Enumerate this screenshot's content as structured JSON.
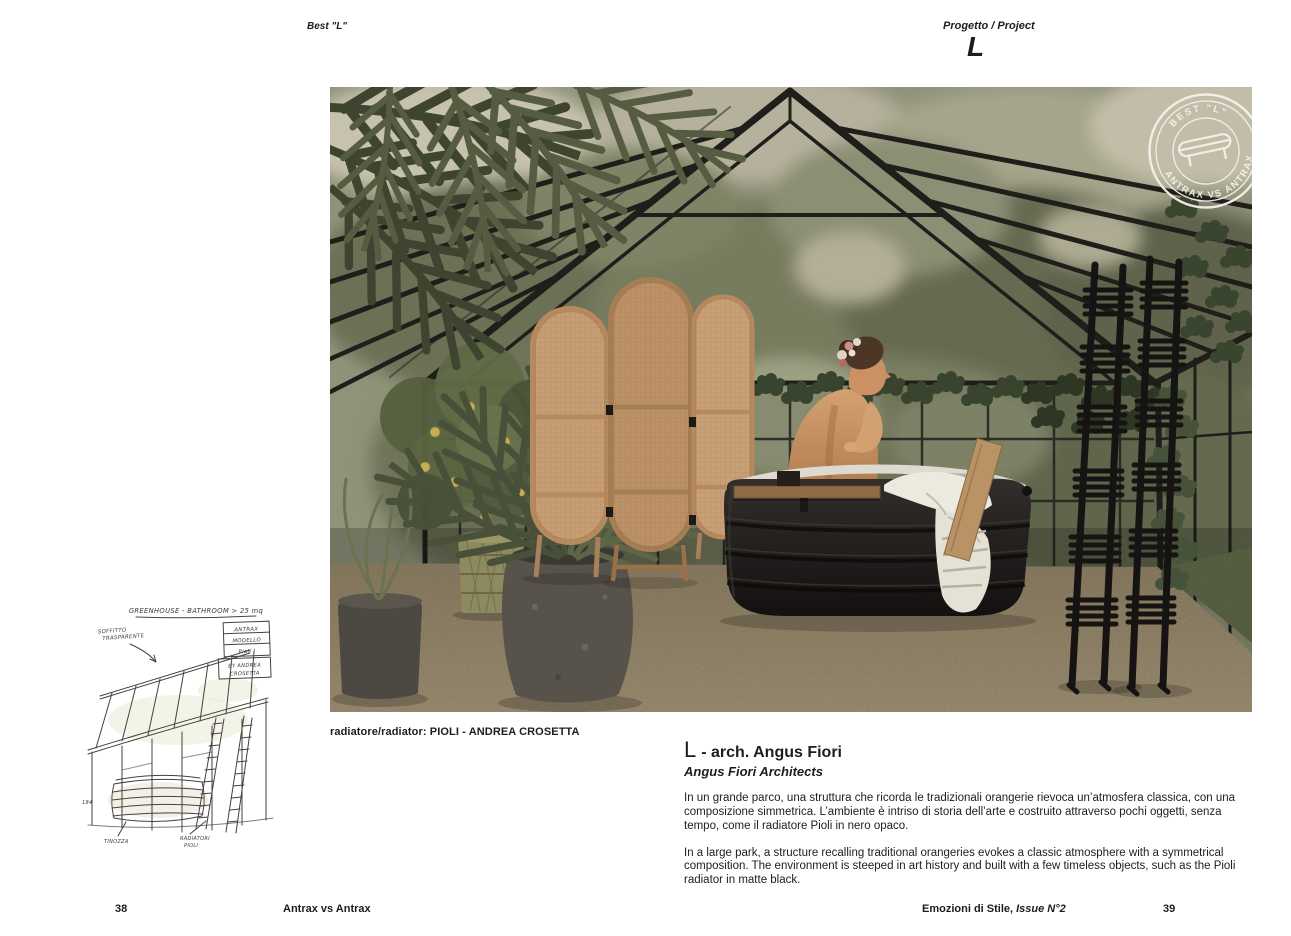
{
  "header": {
    "left_label": "Best \"L\"",
    "right_label": "Progetto / Project",
    "project_letter": "L"
  },
  "photo": {
    "caption": "radiatore/radiator: PIOLI - ANDREA CROSETTA",
    "stamp": {
      "top_text": "BEST \"L\"",
      "bottom_text": "ANTRAX VS ANTRAX"
    }
  },
  "sketch": {
    "title": "GREENHOUSE - BATHROOM > 25 mq",
    "ceiling_1": "SOFFITTO",
    "ceiling_2": "TRASPARENTE",
    "box_1": "ANTRAX",
    "box_2": "MODELLO",
    "box_3": "Pioli !",
    "box_4": "BY ANDREA",
    "box_5": "CROSETTA",
    "tub_label": "TINOZZA",
    "rad_label_1": "RADIATORI",
    "rad_label_2": "PIOLI",
    "number": "184"
  },
  "article": {
    "title_letter": "L",
    "title_rest": "- arch. Angus Fiori",
    "subtitle": "Angus Fiori Architects",
    "paragraph_it": "In un grande parco, una struttura che ricorda le tradizionali orangerie rievoca un’atmosfera classica, con una composizione simmetrica. L’ambiente è intriso di storia dell’arte e costruito attraverso pochi oggetti, senza tempo, come il radiatore Pioli in nero opaco.",
    "paragraph_en": "In a large park, a structure recalling traditional orangeries evokes a classic atmosphere with a symmetrical composition. The environment is steeped in art history and built with a few timeless objects, such as the Pioli radiator in matte black."
  },
  "footer": {
    "page_left": "38",
    "brand": "Antrax vs Antrax",
    "magazine": "Emozioni di Stile, ",
    "issue": "Issue N°2",
    "page_right": "39"
  },
  "palette": {
    "page_background": "#ffffff",
    "text": "#1d1d1b",
    "floor_tan": "#aa9979",
    "rattan_screen": "#c49a70",
    "foliage_dark": "#49503a",
    "tub_black": "#1f1d1b",
    "stamp_white": "#f4f1ea"
  }
}
